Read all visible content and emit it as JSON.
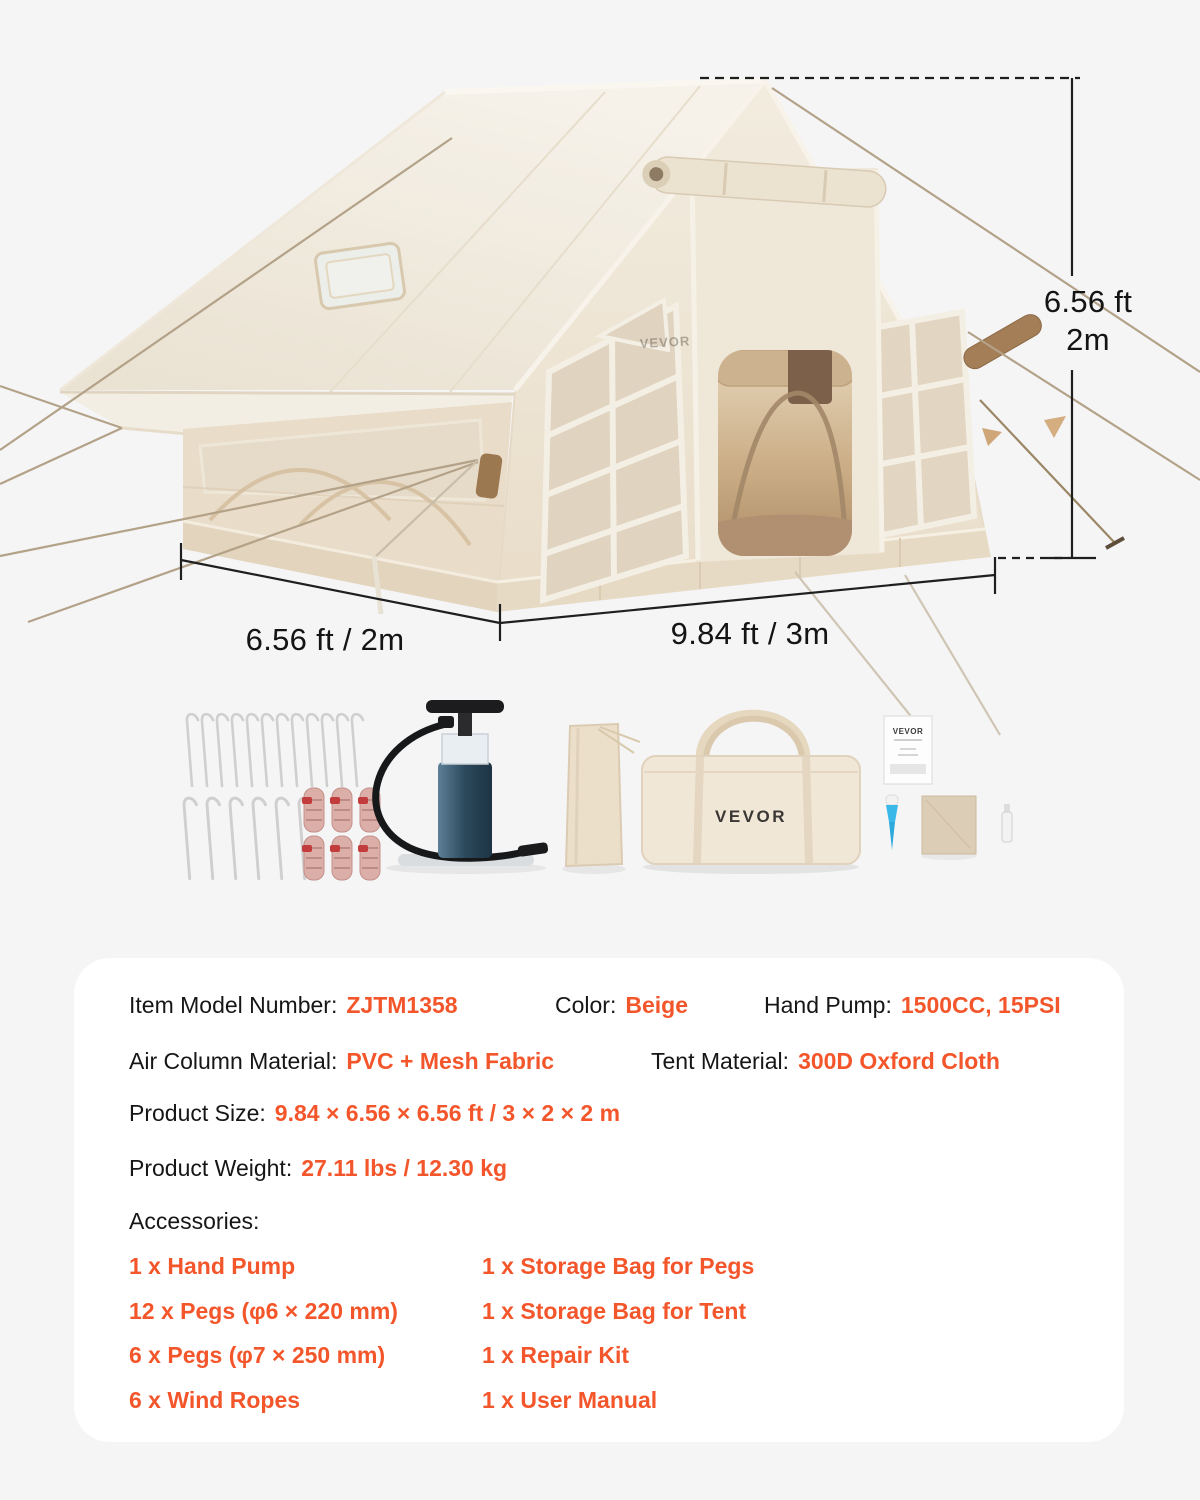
{
  "page": {
    "background": "#f5f5f6",
    "accent": "#F4562B",
    "text_color": "#161616",
    "tent_fabric_color": "#efe8da"
  },
  "product_image": {
    "brand_logo_on_tent": "VEVOR",
    "dimension_labels": {
      "height_ft": "6.56 ft",
      "height_m": "2m",
      "side_width": "6.56 ft / 2m",
      "front_length": "9.84 ft / 3m"
    },
    "accessory_items": {
      "tote_bag_logo": "VEVOR",
      "manual_brand": "VEVOR"
    }
  },
  "specs": {
    "model": {
      "label": "Item Model Number:",
      "value": "ZJTM1358"
    },
    "color": {
      "label": "Color:",
      "value": "Beige"
    },
    "pump": {
      "label": "Hand Pump:",
      "value": "1500CC, 15PSI"
    },
    "air_column": {
      "label": "Air Column Material:",
      "value": "PVC + Mesh Fabric"
    },
    "tent_material": {
      "label": "Tent Material:",
      "value": "300D Oxford Cloth"
    },
    "size": {
      "label": "Product Size:",
      "value": "9.84 × 6.56 × 6.56 ft / 3 × 2 × 2 m"
    },
    "weight": {
      "label": "Product Weight:",
      "value": "27.11 lbs / 12.30 kg"
    },
    "accessories_heading": "Accessories:",
    "accessories": {
      "col1": [
        "1 x Hand Pump",
        "12 x Pegs (φ6 × 220 mm)",
        "6 x Pegs (φ7 × 250 mm)",
        "6 x Wind Ropes"
      ],
      "col2": [
        "1 x Storage Bag for Pegs",
        "1 x Storage Bag for Tent",
        "1 x Repair Kit",
        "1 x User Manual"
      ]
    }
  }
}
